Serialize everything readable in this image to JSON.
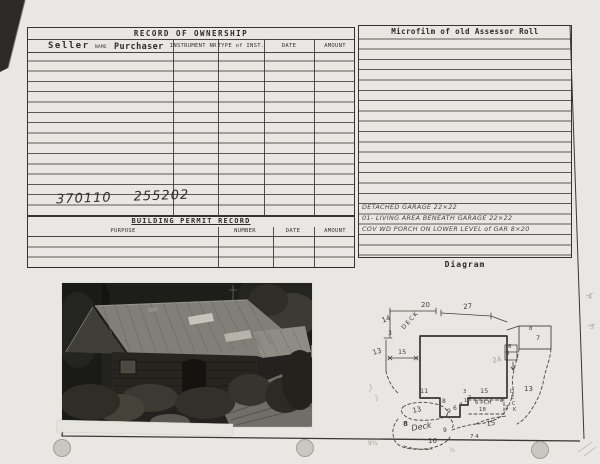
{
  "colors": {
    "paper": "#e9e7e3",
    "ink": "#34322d",
    "pencil": "#a09d92"
  },
  "ownership": {
    "title": "RECORD OF OWNERSHIP",
    "col_seller": "Seller",
    "col_name": "NAME",
    "col_purchaser": "Purchaser",
    "col_instrument": "INSTRUMENT NR.",
    "col_type": "TYPE of INST.",
    "col_date": "DATE",
    "col_amount": "AMOUNT",
    "entry": {
      "seller_no": "370110",
      "purchaser_no": "255202"
    }
  },
  "permit": {
    "title": "BUILDING PERMIT RECORD",
    "col_purpose": "PURPOSE",
    "col_number": "NUMBER",
    "col_date": "DATE",
    "col_amount": "AMOUNT"
  },
  "microfilm": {
    "title": "Microfilm of old Assessor Roll",
    "notes": [
      "DETACHED GARAGE  22×22",
      "01- LIVING AREA BENEATH GARAGE 22×22",
      "COV WD PORCH ON LOWER LEVEL of GAR  8×20"
    ]
  },
  "diagram": {
    "title": "Diagram",
    "labels": [
      {
        "t": "20",
        "x": 421,
        "y": 302
      },
      {
        "t": "27",
        "x": 463,
        "y": 304,
        "r": -6
      },
      {
        "t": "14",
        "x": 381,
        "y": 318,
        "r": -20
      },
      {
        "t": "DECK",
        "x": 401,
        "y": 327,
        "r": -48,
        "ls": 1.5,
        "s": 6
      },
      {
        "t": "3",
        "x": 388,
        "y": 331,
        "s": 6
      },
      {
        "t": "13",
        "x": 372,
        "y": 350,
        "r": -15
      },
      {
        "t": "15",
        "x": 398,
        "y": 349,
        "s": 6.5
      },
      {
        "t": "11",
        "x": 420,
        "y": 388,
        "s": 6.5
      },
      {
        "t": "8",
        "x": 442,
        "y": 399,
        "s": 6
      },
      {
        "t": "9",
        "x": 447,
        "y": 409,
        "s": 6
      },
      {
        "t": "6",
        "x": 453,
        "y": 406,
        "s": 6
      },
      {
        "t": "4",
        "x": 459,
        "y": 403,
        "s": 5.5
      },
      {
        "t": "1",
        "x": 464,
        "y": 399,
        "s": 5
      },
      {
        "t": "2",
        "x": 468,
        "y": 396,
        "s": 5
      },
      {
        "t": "3",
        "x": 463,
        "y": 390,
        "s": 5
      },
      {
        "t": "15",
        "x": 480,
        "y": 388,
        "s": 6.5
      },
      {
        "t": "6 PCH",
        "x": 475,
        "y": 401,
        "s": 5.5
      },
      {
        "t": "18",
        "x": 479,
        "y": 408,
        "s": 5.5
      },
      {
        "t": "8",
        "x": 500,
        "y": 399,
        "s": 5.5
      },
      {
        "t": "2",
        "x": 505,
        "y": 406,
        "s": 5.5
      },
      {
        "t": "8",
        "x": 529,
        "y": 327,
        "s": 5.5
      },
      {
        "t": "7",
        "x": 536,
        "y": 335,
        "s": 6.5
      },
      {
        "t": "6",
        "x": 508,
        "y": 345,
        "s": 5.5
      },
      {
        "t": "5",
        "x": 506,
        "y": 352,
        "s": 5.5
      },
      {
        "t": "13",
        "x": 524,
        "y": 386
      },
      {
        "t": "D",
        "x": 510,
        "y": 390,
        "s": 5
      },
      {
        "t": "E",
        "x": 511,
        "y": 396,
        "s": 5
      },
      {
        "t": "C",
        "x": 512,
        "y": 402,
        "s": 5
      },
      {
        "t": "K",
        "x": 513,
        "y": 408,
        "s": 5
      },
      {
        "t": "13",
        "x": 412,
        "y": 408,
        "r": -12
      },
      {
        "t": "8",
        "x": 403,
        "y": 421,
        "b": 1
      },
      {
        "t": "Deck",
        "x": 411,
        "y": 425,
        "r": -10,
        "s": 8,
        "i": 1
      },
      {
        "t": "16",
        "x": 428,
        "y": 438
      },
      {
        "t": "15",
        "x": 486,
        "y": 421,
        "r": -8
      },
      {
        "t": "9",
        "x": 443,
        "y": 428,
        "s": 6
      },
      {
        "t": "7 4",
        "x": 470,
        "y": 435,
        "s": 5.5
      },
      {
        "t": "24",
        "x": 492,
        "y": 358,
        "c": "pencil",
        "r": -12
      },
      {
        "t": "9¼",
        "x": 368,
        "y": 441,
        "c": "pencil",
        "s": 6
      },
      {
        "t": "⅞",
        "x": 449,
        "y": 448,
        "c": "pencil",
        "s": 6
      },
      {
        "t": "4",
        "x": 588,
        "y": 295,
        "c": "pencil",
        "s": 6
      },
      {
        "t": "3",
        "x": 590,
        "y": 325,
        "c": "pencil",
        "s": 6
      }
    ]
  }
}
